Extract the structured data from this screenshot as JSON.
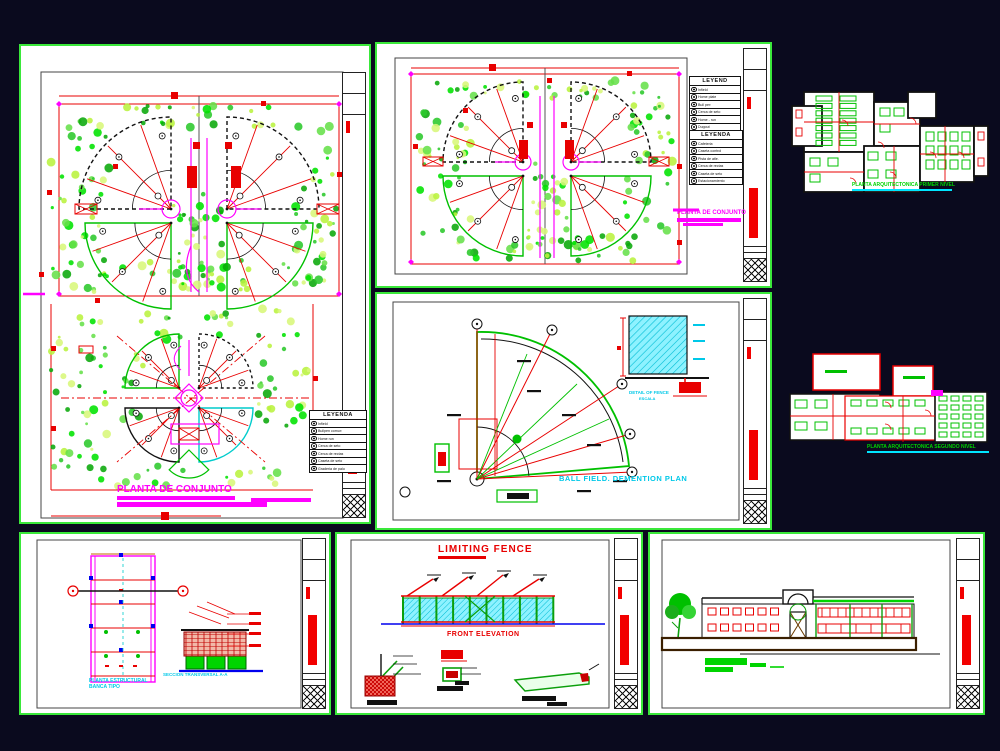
{
  "colors": {
    "bg": "#0a0a1e",
    "sheet_border": "#3ae83a",
    "magenta": "#ff00ff",
    "red": "#f20000",
    "cyan": "#00c8e8",
    "cad_green": "#00d400",
    "blue": "#0000ee"
  },
  "site_plan": {
    "title": "PLANTA DE CONJUNTO",
    "legend": {
      "title": "LEYENDA",
      "rows": [
        "Infield",
        "Bullpen comun",
        "Home run",
        "Cerca de seto",
        "Cerca de rectas",
        "Caseta de seto",
        "Graderia de palo"
      ]
    }
  },
  "site_plan_2": {
    "legend_a": {
      "title": "LEYEND",
      "rows": [
        "Infield",
        "Home plate",
        "Bull pen",
        "Cerca de seto",
        "Home - run",
        "Dugout"
      ]
    },
    "legend_b": {
      "title": "LEYENDA",
      "rows": [
        "Cafeteria",
        "Caseta control",
        "Pista de atle.",
        "Cerca de rectas",
        "Caseta de seto",
        "Estacionamiento"
      ]
    },
    "title_note": "PLANTA DE CONJUNTO"
  },
  "ball_field": {
    "title": "BALL FIELD. DEMENTION PLAN",
    "detail_line1": "DETAIL OF FENCE",
    "detail_line2": "ESCALA"
  },
  "structural": {
    "label_line1": "PLANTA ESTRUCTURAL",
    "label_line2": "BANCA TIPO",
    "section_label": "SECCION TRANSVERSAL A-A"
  },
  "fence": {
    "title": "LIMITING FENCE",
    "elevation_label": "FRONT ELEVATION"
  },
  "floor_plans": {
    "plan1_label": "PLANTA ARQUITECTONICA PRIMER NIVEL",
    "plan2_label": "PLANTA ARQUITECTONICA SEGUNDO NIVEL"
  }
}
